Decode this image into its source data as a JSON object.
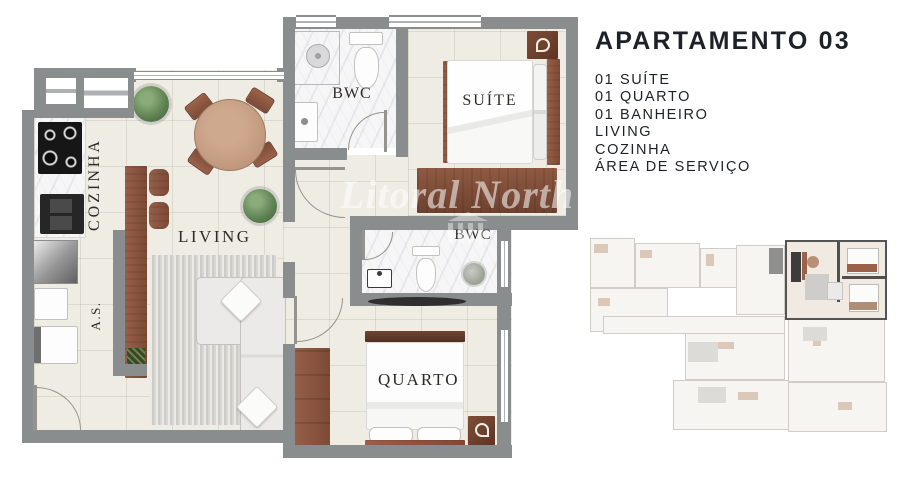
{
  "info": {
    "title": "APARTAMENTO 03",
    "features": [
      "01 SUÍTE",
      "01 QUARTO",
      "01 BANHEIRO",
      "LIVING",
      "COZINHA",
      "ÁREA DE SERVIÇO"
    ]
  },
  "plan": {
    "watermark": "Litoral North",
    "labels": {
      "cozinha": "COZINHA",
      "area_servico": "A.S.",
      "living": "LIVING",
      "bwc_suite": "BWC",
      "bwc_social": "BWC",
      "suite": "SUÍTE",
      "quarto": "QUARTO"
    }
  },
  "colors": {
    "wall": "#8a8d8e",
    "floor": "#efece4",
    "marble": "#f7f6f7",
    "wood_dark": "#7c4a36",
    "wood_light": "#c59c82",
    "text": "#1e2128",
    "plant_green": "#5d8052",
    "watermark": "rgba(255,255,255,0.55)"
  }
}
